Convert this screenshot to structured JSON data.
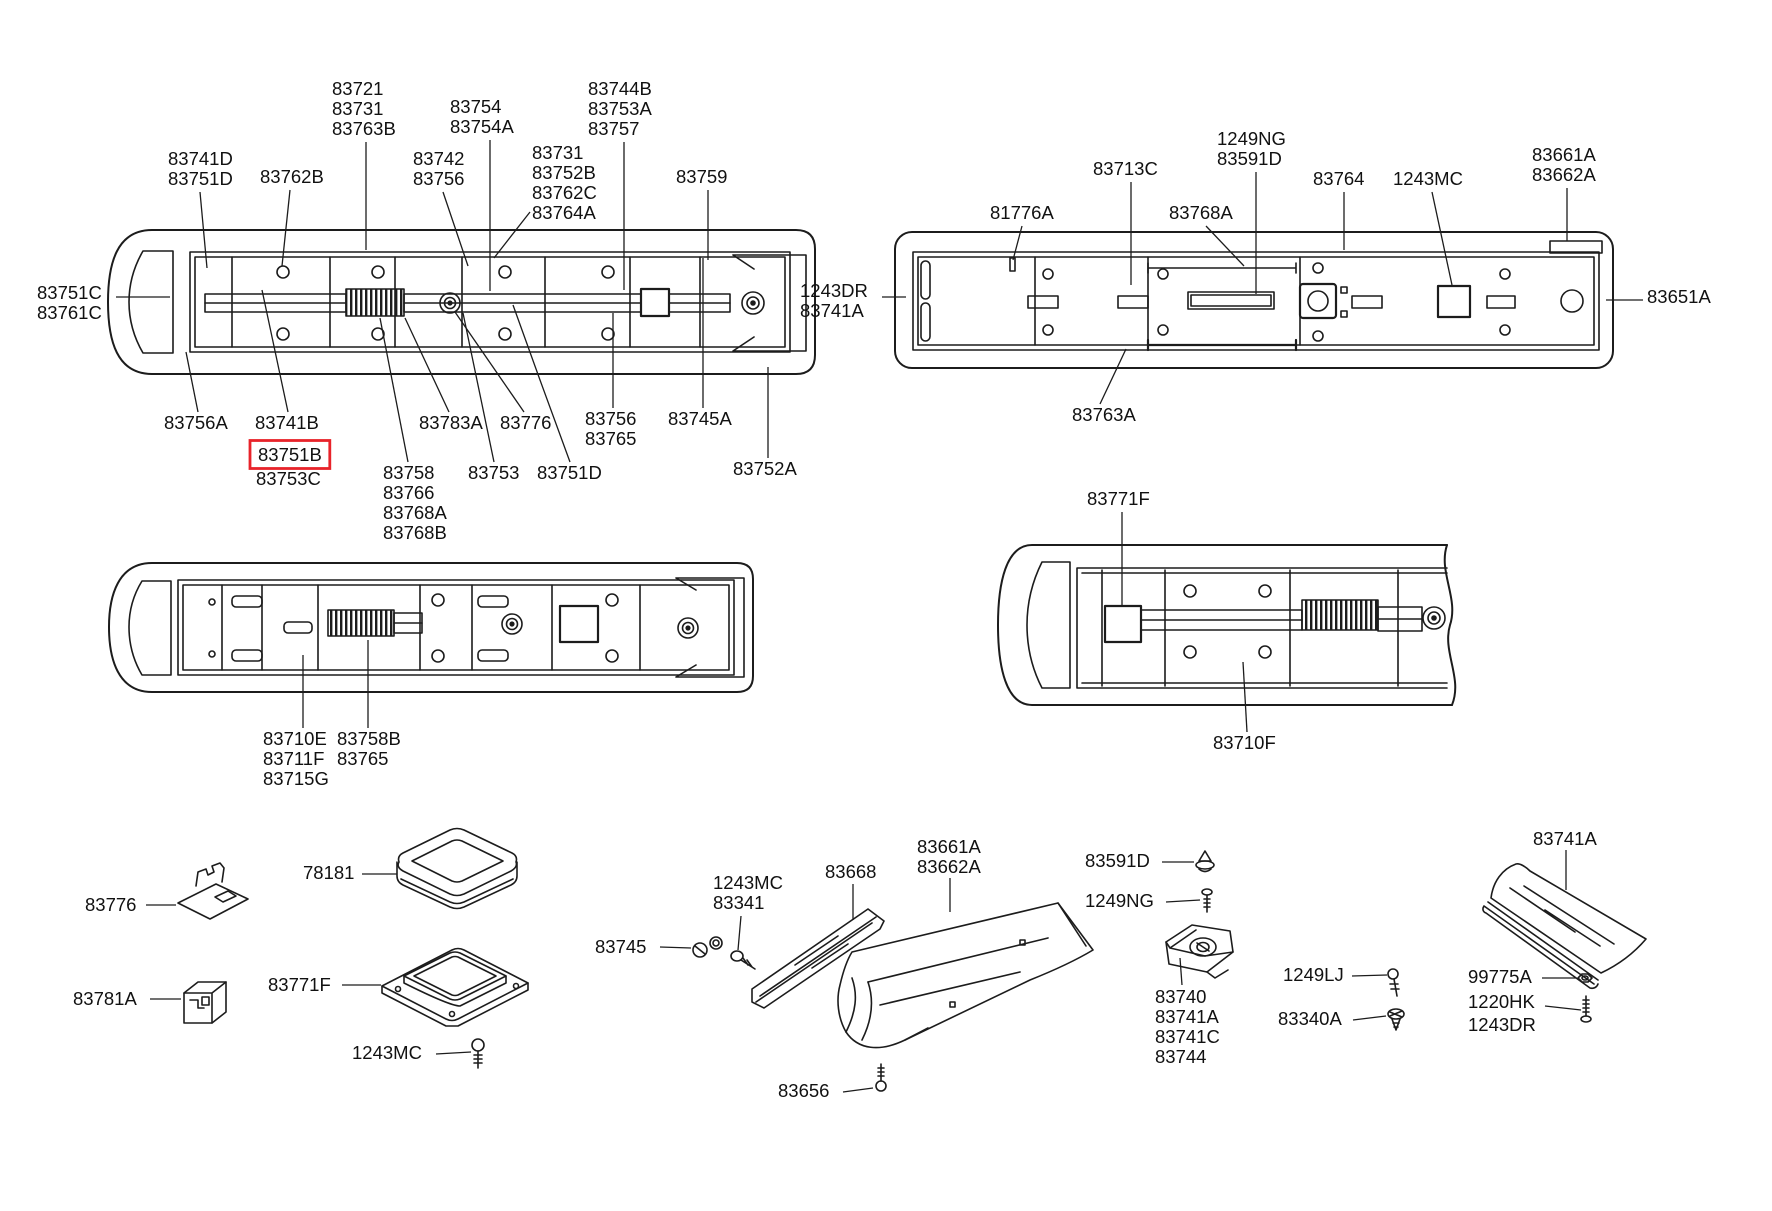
{
  "document": {
    "kind": "parts-catalog-exploded-diagram",
    "highlighted_part": "83751B"
  },
  "colors": {
    "background": "#ffffff",
    "line": "#1c1c1c",
    "text": "#111111",
    "highlight": "#e8232a"
  },
  "labels": [
    {
      "name": "tl-83741d-83751d",
      "x": 168,
      "y": 150,
      "lines": [
        "83741D",
        "83751D"
      ],
      "leader": [
        [
          200,
          192
        ],
        [
          207,
          268
        ]
      ]
    },
    {
      "name": "tl-83762b",
      "x": 260,
      "y": 168,
      "lines": [
        "83762B"
      ],
      "leader": [
        [
          290,
          190
        ],
        [
          282,
          266
        ]
      ]
    },
    {
      "name": "tl-83721-col",
      "x": 332,
      "y": 80,
      "lines": [
        "83721",
        "83731",
        "83763B"
      ],
      "leader": [
        [
          366,
          142
        ],
        [
          366,
          250
        ]
      ]
    },
    {
      "name": "tl-83754-col",
      "x": 450,
      "y": 98,
      "lines": [
        "83754",
        "83754A"
      ],
      "leader": [
        [
          490,
          140
        ],
        [
          490,
          291
        ]
      ]
    },
    {
      "name": "tl-83744b-col",
      "x": 588,
      "y": 80,
      "lines": [
        "83744B",
        "83753A",
        "83757"
      ],
      "leader": [
        [
          624,
          142
        ],
        [
          624,
          290
        ]
      ]
    },
    {
      "name": "tl-83742-col",
      "x": 413,
      "y": 150,
      "lines": [
        "83742",
        "83756"
      ],
      "leader": [
        [
          443,
          192
        ],
        [
          468,
          266
        ]
      ]
    },
    {
      "name": "tl-83731-col",
      "x": 532,
      "y": 144,
      "lines": [
        "83731",
        "83752B",
        "83762C",
        "83764A"
      ],
      "leader": [
        [
          530,
          212
        ],
        [
          494,
          258
        ]
      ]
    },
    {
      "name": "tl-83759",
      "x": 676,
      "y": 168,
      "lines": [
        "83759"
      ],
      "leader": [
        [
          708,
          190
        ],
        [
          708,
          260
        ]
      ]
    },
    {
      "name": "tl-83751c-83761c",
      "x": 37,
      "y": 284,
      "lines": [
        "83751C",
        "83761C"
      ],
      "leader": [
        [
          116,
          297
        ],
        [
          170,
          297
        ]
      ]
    },
    {
      "name": "tl-83756a",
      "x": 164,
      "y": 414,
      "lines": [
        "83756A"
      ],
      "leader": [
        [
          198,
          412
        ],
        [
          186,
          352
        ]
      ]
    },
    {
      "name": "tl-83741b",
      "x": 255,
      "y": 414,
      "lines": [
        "83741B"
      ],
      "leader": [
        [
          288,
          412
        ],
        [
          262,
          290
        ]
      ]
    },
    {
      "name": "tl-83751b",
      "x": 258,
      "y": 446,
      "lines": [
        "83751B"
      ],
      "boxed": true
    },
    {
      "name": "tl-83753c",
      "x": 256,
      "y": 470,
      "lines": [
        "83753C"
      ]
    },
    {
      "name": "tl-83783a",
      "x": 419,
      "y": 414,
      "lines": [
        "83783A"
      ],
      "leader": [
        [
          449,
          412
        ],
        [
          405,
          318
        ]
      ]
    },
    {
      "name": "tl-83776",
      "x": 500,
      "y": 414,
      "lines": [
        "83776"
      ],
      "leader": [
        [
          524,
          412
        ],
        [
          455,
          312
        ]
      ]
    },
    {
      "name": "tl-83756-83765",
      "x": 585,
      "y": 410,
      "lines": [
        "83756",
        "83765"
      ],
      "leader": [
        [
          613,
          408
        ],
        [
          613,
          313
        ]
      ]
    },
    {
      "name": "tl-83745a",
      "x": 668,
      "y": 410,
      "lines": [
        "83745A"
      ],
      "leader": [
        [
          703,
          408
        ],
        [
          703,
          258
        ]
      ]
    },
    {
      "name": "tl-83758-col",
      "x": 383,
      "y": 464,
      "lines": [
        "83758",
        "83766",
        "83768A",
        "83768B"
      ],
      "leader": [
        [
          408,
          462
        ],
        [
          380,
          318
        ]
      ]
    },
    {
      "name": "tl-83753",
      "x": 468,
      "y": 464,
      "lines": [
        "83753"
      ],
      "leader": [
        [
          494,
          462
        ],
        [
          463,
          313
        ]
      ]
    },
    {
      "name": "tl-83751d-bot",
      "x": 537,
      "y": 464,
      "lines": [
        "83751D"
      ],
      "leader": [
        [
          570,
          462
        ],
        [
          540,
          380
        ],
        [
          513,
          305
        ]
      ]
    },
    {
      "name": "tl-83752a",
      "x": 733,
      "y": 460,
      "lines": [
        "83752A"
      ],
      "leader": [
        [
          768,
          458
        ],
        [
          768,
          367
        ]
      ]
    },
    {
      "name": "tr-81776a",
      "x": 990,
      "y": 204,
      "lines": [
        "81776A"
      ],
      "leader": [
        [
          1022,
          226
        ],
        [
          1013,
          260
        ]
      ]
    },
    {
      "name": "tr-83713c",
      "x": 1093,
      "y": 160,
      "lines": [
        "83713C"
      ],
      "leader": [
        [
          1131,
          182
        ],
        [
          1131,
          285
        ]
      ]
    },
    {
      "name": "tr-1249ng-83591d",
      "x": 1217,
      "y": 130,
      "lines": [
        "1249NG",
        "83591D"
      ],
      "leader": [
        [
          1256,
          172
        ],
        [
          1256,
          294
        ]
      ]
    },
    {
      "name": "tr-83768a",
      "x": 1169,
      "y": 204,
      "lines": [
        "83768A"
      ],
      "leader": [
        [
          1206,
          226
        ],
        [
          1244,
          266
        ]
      ]
    },
    {
      "name": "tr-83764",
      "x": 1313,
      "y": 170,
      "lines": [
        "83764"
      ],
      "leader": [
        [
          1344,
          192
        ],
        [
          1344,
          250
        ]
      ]
    },
    {
      "name": "tr-1243mc",
      "x": 1393,
      "y": 170,
      "lines": [
        "1243MC"
      ],
      "leader": [
        [
          1432,
          192
        ],
        [
          1452,
          285
        ]
      ]
    },
    {
      "name": "tr-83661a-83662a",
      "x": 1532,
      "y": 146,
      "lines": [
        "83661A",
        "83662A"
      ],
      "leader": [
        [
          1567,
          188
        ],
        [
          1567,
          241
        ]
      ]
    },
    {
      "name": "tr-1243dr-83741a",
      "x": 800,
      "y": 282,
      "lines": [
        "1243DR",
        "83741A"
      ],
      "leader": [
        [
          882,
          297
        ],
        [
          906,
          297
        ]
      ]
    },
    {
      "name": "tr-83651a",
      "x": 1647,
      "y": 288,
      "lines": [
        "83651A"
      ],
      "leader": [
        [
          1643,
          300
        ],
        [
          1606,
          300
        ]
      ]
    },
    {
      "name": "tr-83763a",
      "x": 1072,
      "y": 406,
      "lines": [
        "83763A"
      ],
      "leader": [
        [
          1100,
          404
        ],
        [
          1126,
          349
        ]
      ]
    },
    {
      "name": "ml-83710e-col",
      "x": 263,
      "y": 730,
      "lines": [
        "83710E",
        "83711F",
        "83715G"
      ],
      "leader": [
        [
          303,
          728
        ],
        [
          303,
          655
        ]
      ]
    },
    {
      "name": "ml-83758b-col",
      "x": 337,
      "y": 730,
      "lines": [
        "83758B",
        "83765"
      ],
      "leader": [
        [
          368,
          728
        ],
        [
          368,
          640
        ]
      ]
    },
    {
      "name": "mr-83771f",
      "x": 1087,
      "y": 490,
      "lines": [
        "83771F"
      ],
      "leader": [
        [
          1122,
          512
        ],
        [
          1122,
          605
        ]
      ]
    },
    {
      "name": "mr-83710f",
      "x": 1213,
      "y": 734,
      "lines": [
        "83710F"
      ],
      "leader": [
        [
          1247,
          732
        ],
        [
          1243,
          662
        ]
      ]
    },
    {
      "name": "b-83776",
      "x": 85,
      "y": 896,
      "lines": [
        "83776"
      ],
      "leader": [
        [
          146,
          905
        ],
        [
          176,
          905
        ]
      ]
    },
    {
      "name": "b-78181",
      "x": 303,
      "y": 864,
      "lines": [
        "78181"
      ],
      "leader": [
        [
          362,
          874
        ],
        [
          397,
          874
        ]
      ]
    },
    {
      "name": "b-83781a",
      "x": 73,
      "y": 990,
      "lines": [
        "83781A"
      ],
      "leader": [
        [
          150,
          999
        ],
        [
          181,
          999
        ]
      ]
    },
    {
      "name": "b-83771f",
      "x": 268,
      "y": 976,
      "lines": [
        "83771F"
      ],
      "leader": [
        [
          342,
          985
        ],
        [
          381,
          985
        ]
      ]
    },
    {
      "name": "b-1243mc",
      "x": 352,
      "y": 1044,
      "lines": [
        "1243MC"
      ],
      "leader": [
        [
          436,
          1054
        ],
        [
          471,
          1052
        ]
      ]
    },
    {
      "name": "b-83745",
      "x": 595,
      "y": 938,
      "lines": [
        "83745"
      ],
      "leader": [
        [
          660,
          947
        ],
        [
          691,
          948
        ]
      ]
    },
    {
      "name": "b-1243mc-83341",
      "x": 713,
      "y": 874,
      "lines": [
        "1243MC",
        "83341"
      ],
      "leader": [
        [
          741,
          916
        ],
        [
          738,
          950
        ]
      ]
    },
    {
      "name": "b-83668",
      "x": 825,
      "y": 863,
      "lines": [
        "83668"
      ],
      "leader": [
        [
          853,
          884
        ],
        [
          853,
          920
        ]
      ]
    },
    {
      "name": "b-83661a-83662a",
      "x": 917,
      "y": 838,
      "lines": [
        "83661A",
        "83662A"
      ],
      "leader": [
        [
          950,
          878
        ],
        [
          950,
          912
        ]
      ]
    },
    {
      "name": "b-83656",
      "x": 778,
      "y": 1082,
      "lines": [
        "83656"
      ],
      "leader": [
        [
          843,
          1092
        ],
        [
          873,
          1088
        ]
      ]
    },
    {
      "name": "b-83591d",
      "x": 1085,
      "y": 852,
      "lines": [
        "83591D"
      ],
      "leader": [
        [
          1162,
          862
        ],
        [
          1194,
          862
        ]
      ]
    },
    {
      "name": "b-1249ng",
      "x": 1085,
      "y": 892,
      "lines": [
        "1249NG"
      ],
      "leader": [
        [
          1166,
          902
        ],
        [
          1200,
          900
        ]
      ]
    },
    {
      "name": "b-83740-col",
      "x": 1155,
      "y": 988,
      "lines": [
        "83740",
        "83741A",
        "83741C",
        "83744"
      ],
      "leader": [
        [
          1182,
          985
        ],
        [
          1180,
          958
        ]
      ]
    },
    {
      "name": "b-1249lj",
      "x": 1283,
      "y": 966,
      "lines": [
        "1249LJ"
      ],
      "leader": [
        [
          1352,
          976
        ],
        [
          1387,
          975
        ]
      ]
    },
    {
      "name": "b-83340a",
      "x": 1278,
      "y": 1010,
      "lines": [
        "83340A"
      ],
      "leader": [
        [
          1353,
          1020
        ],
        [
          1386,
          1016
        ]
      ]
    },
    {
      "name": "b-83741a",
      "x": 1533,
      "y": 830,
      "lines": [
        "83741A"
      ],
      "leader": [
        [
          1566,
          850
        ],
        [
          1566,
          890
        ]
      ]
    },
    {
      "name": "b-99775a",
      "x": 1468,
      "y": 968,
      "lines": [
        "99775A"
      ],
      "leader": [
        [
          1542,
          978
        ],
        [
          1576,
          978
        ]
      ]
    },
    {
      "name": "b-1220hk",
      "x": 1468,
      "y": 993,
      "lines": [
        "1220HK"
      ],
      "leader": [
        [
          1545,
          1006
        ],
        [
          1581,
          1010
        ]
      ]
    },
    {
      "name": "b-1243dr",
      "x": 1468,
      "y": 1016,
      "lines": [
        "1243DR"
      ]
    }
  ]
}
